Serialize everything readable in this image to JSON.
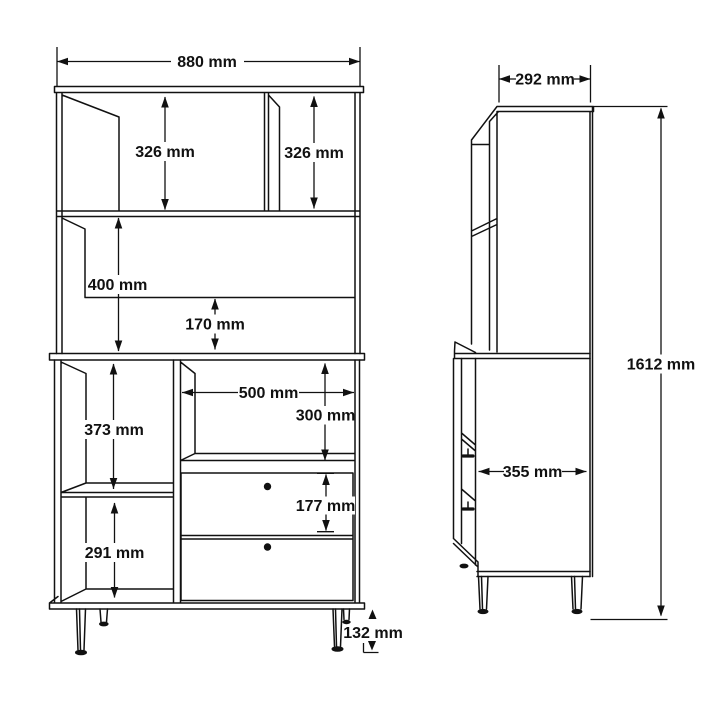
{
  "page": {
    "background_color": "#ffffff",
    "line_color": "#111111"
  },
  "drawing": {
    "front_view": {
      "overall_width": "880 mm",
      "top_left_compartment_height": "326 mm",
      "top_right_compartment_height": "326 mm",
      "middle_open_section_height": "400 mm",
      "back_panel_gap_height": "170 mm",
      "drawer_compartment_width": "500 mm",
      "open_compartment_height": "300 mm",
      "lower_left_upper_compartment_height": "373 mm",
      "drawer_front_height": "177 mm",
      "lower_left_lower_compartment_height": "291 mm",
      "leg_height": "132 mm"
    },
    "side_view": {
      "upper_depth": "292 mm",
      "lower_depth": "355 mm",
      "overall_height": "1612 mm"
    }
  }
}
